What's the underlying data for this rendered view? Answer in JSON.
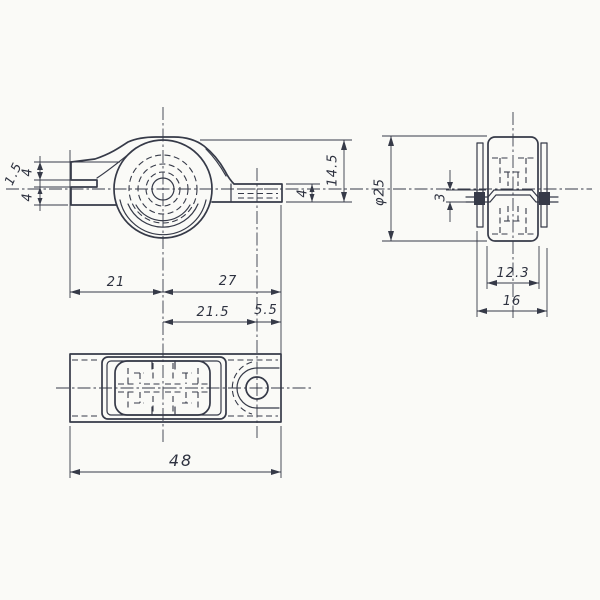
{
  "drawing": {
    "paper_color": "#fafaf7",
    "ink_color": "#363a48",
    "views": [
      "side-view",
      "section-view",
      "plan-view"
    ],
    "dims": {
      "side_left_top": "4",
      "side_left_gap": "1.5",
      "side_left_bottom": "4",
      "side_tab_thickness": "4",
      "side_height": "14.5",
      "sec_diameter": "φ25",
      "sec_axle": "3",
      "sec_groove": "12.3",
      "sec_width": "16",
      "plan_left": "21",
      "plan_right": "27",
      "plan_hole_offset": "21.5",
      "plan_hole_edge": "5.5",
      "plan_total": "48"
    }
  }
}
